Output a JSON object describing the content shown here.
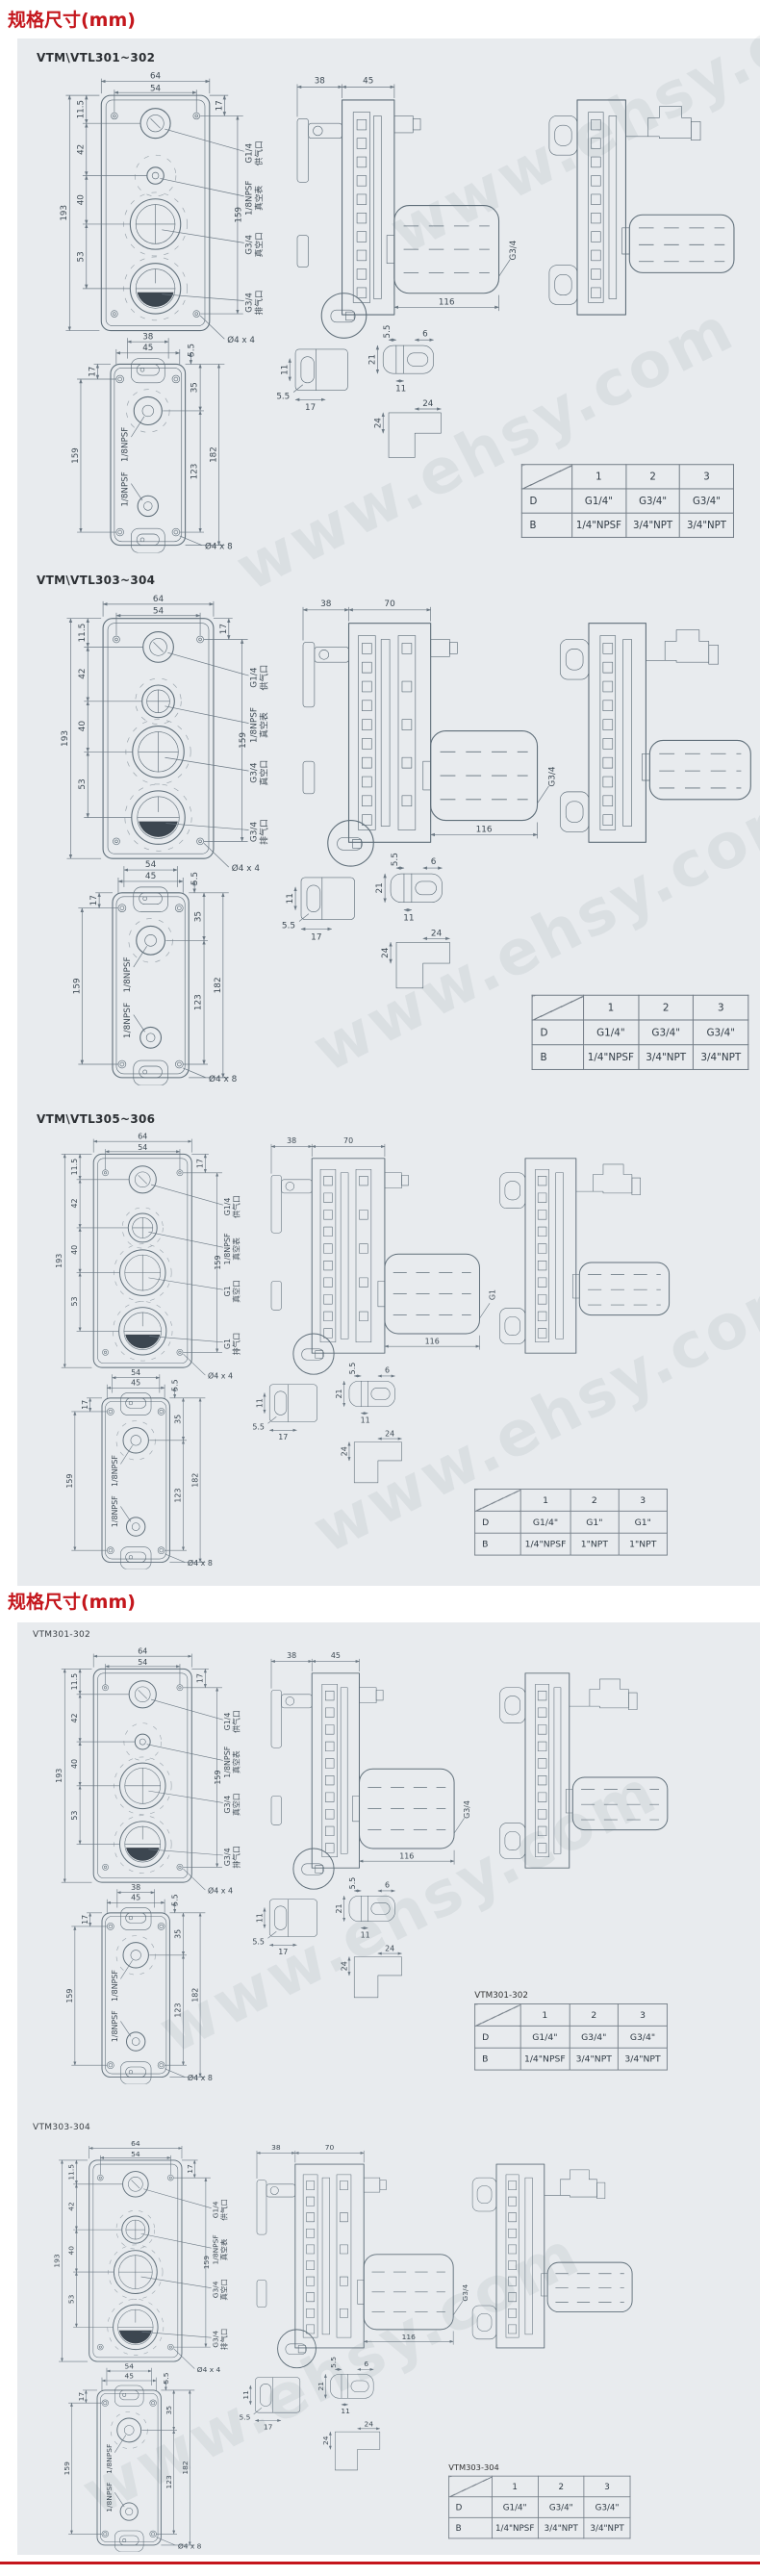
{
  "page": {
    "header1": "规格尺寸(mm)",
    "header2": "规格尺寸(mm)",
    "watermark": "www.ehsy.com",
    "accent_red": "#c4161c",
    "panel_bg": "#e8ebee"
  },
  "sections": [
    {
      "label": "VTM\\VTL301~302",
      "template": "A",
      "front": {
        "dim_w": "64",
        "dim_w2": "54",
        "dim_t": "11.5",
        "dim_s1": "42",
        "dim_s2": "40",
        "dim_s3": "53",
        "dim_h": "193",
        "dim_h2": "159",
        "dim_c": "17",
        "holes": "Ø4 x 4"
      },
      "labels": {
        "supply": "G1/4",
        "supply_cn": "供气口",
        "gauge": "1/8NPSF",
        "gauge_cn": "真空表",
        "vacuum": "G3/4",
        "vacuum_cn": "真空口",
        "exhaust": "G3/4",
        "exhaust_cn": "排气口"
      },
      "side": {
        "dim_a": "38",
        "dim_b": "45",
        "dim_len": "116",
        "muffler": "G3/4"
      },
      "rear": {
        "dim_a": "38",
        "dim_b": "45",
        "dim_corner": "17",
        "dim_off": "5.5",
        "dim_r1": "35",
        "dim_r2": "123",
        "dim_left": "159",
        "dim_total": "182",
        "port1": "1/8NPSF",
        "port2": "1/8NPSF",
        "holes": "Ø4 x 8"
      },
      "parts": {
        "a1": "11",
        "a2": "5.5",
        "a3": "17",
        "b1": "5.5",
        "b2": "6",
        "b3": "21",
        "b4": "11",
        "c1": "24",
        "c2": "24"
      },
      "table": {
        "title": "",
        "cols": [
          "1",
          "2",
          "3"
        ],
        "rows": [
          {
            "h": "D",
            "v": [
              "G1/4\"",
              "G3/4\"",
              "G3/4\""
            ]
          },
          {
            "h": "B",
            "v": [
              "1/4\"NPSF",
              "3/4\"NPT",
              "3/4\"NPT"
            ]
          }
        ]
      }
    },
    {
      "label": "VTM\\VTL303~304",
      "template": "B",
      "front": {
        "dim_w": "64",
        "dim_w2": "54",
        "dim_t": "11.5",
        "dim_s1": "42",
        "dim_s2": "40",
        "dim_s3": "53",
        "dim_h": "193",
        "dim_h2": "159",
        "dim_c": "17",
        "holes": "Ø4 x 4"
      },
      "labels": {
        "supply": "G1/4",
        "supply_cn": "供气口",
        "gauge": "1/8NPSF",
        "gauge_cn": "真空表",
        "vacuum": "G3/4",
        "vacuum_cn": "真空口",
        "exhaust": "G3/4",
        "exhaust_cn": "排气口"
      },
      "side": {
        "dim_a": "38",
        "dim_b": "70",
        "dim_len": "116",
        "muffler": "G3/4"
      },
      "rear": {
        "dim_a": "54",
        "dim_b": "45",
        "dim_corner": "17",
        "dim_off": "5.5",
        "dim_r1": "35",
        "dim_r2": "123",
        "dim_left": "159",
        "dim_total": "182",
        "port1": "1/8NPSF",
        "port2": "1/8NPSF",
        "holes": "Ø4 x 8"
      },
      "parts": {
        "a1": "11",
        "a2": "5.5",
        "a3": "17",
        "b1": "5.5",
        "b2": "6",
        "b3": "21",
        "b4": "11",
        "c1": "24",
        "c2": "24"
      },
      "table": {
        "title": "",
        "cols": [
          "1",
          "2",
          "3"
        ],
        "rows": [
          {
            "h": "D",
            "v": [
              "G1/4\"",
              "G3/4\"",
              "G3/4\""
            ]
          },
          {
            "h": "B",
            "v": [
              "1/4\"NPSF",
              "3/4\"NPT",
              "3/4\"NPT"
            ]
          }
        ]
      }
    },
    {
      "label": "VTM\\VTL305~306",
      "template": "B",
      "front": {
        "dim_w": "64",
        "dim_w2": "54",
        "dim_t": "11.5",
        "dim_s1": "42",
        "dim_s2": "40",
        "dim_s3": "53",
        "dim_h": "193",
        "dim_h2": "159",
        "dim_c": "17",
        "holes": "Ø4 x 4"
      },
      "labels": {
        "supply": "G1/4",
        "supply_cn": "供气口",
        "gauge": "1/8NPSF",
        "gauge_cn": "真空表",
        "vacuum": "G1",
        "vacuum_cn": "真空口",
        "exhaust": "G1",
        "exhaust_cn": "排气口"
      },
      "side": {
        "dim_a": "38",
        "dim_b": "70",
        "dim_len": "116",
        "muffler": "G1"
      },
      "rear": {
        "dim_a": "54",
        "dim_b": "45",
        "dim_corner": "17",
        "dim_off": "5.5",
        "dim_r1": "35",
        "dim_r2": "123",
        "dim_left": "159",
        "dim_total": "182",
        "port1": "1/8NPSF",
        "port2": "1/8NPSF",
        "holes": "Ø4 x 8"
      },
      "parts": {
        "a1": "11",
        "a2": "5.5",
        "a3": "17",
        "b1": "5.5",
        "b2": "6",
        "b3": "21",
        "b4": "11",
        "c1": "24",
        "c2": "24"
      },
      "table": {
        "title": "",
        "cols": [
          "1",
          "2",
          "3"
        ],
        "rows": [
          {
            "h": "D",
            "v": [
              "G1/4\"",
              "G1\"",
              "G1\""
            ]
          },
          {
            "h": "B",
            "v": [
              "1/4\"NPSF",
              "1\"NPT",
              "1\"NPT"
            ]
          }
        ]
      }
    },
    {
      "label": "VTM301-302",
      "template": "A",
      "front": {
        "dim_w": "64",
        "dim_w2": "54",
        "dim_t": "11.5",
        "dim_s1": "42",
        "dim_s2": "40",
        "dim_s3": "53",
        "dim_h": "193",
        "dim_h2": "159",
        "dim_c": "17",
        "holes": "Ø4 x 4"
      },
      "labels": {
        "supply": "G1/4",
        "supply_cn": "供气口",
        "gauge": "1/8NPSF",
        "gauge_cn": "真空表",
        "vacuum": "G3/4",
        "vacuum_cn": "真空口",
        "exhaust": "G3/4",
        "exhaust_cn": "排气口"
      },
      "side": {
        "dim_a": "38",
        "dim_b": "45",
        "dim_len": "116",
        "muffler": "G3/4"
      },
      "rear": {
        "dim_a": "38",
        "dim_b": "45",
        "dim_corner": "17",
        "dim_off": "5.5",
        "dim_r1": "35",
        "dim_r2": "123",
        "dim_left": "159",
        "dim_total": "182",
        "port1": "1/8NPSF",
        "port2": "1/8NPSF",
        "holes": "Ø4 x 8"
      },
      "parts": {
        "a1": "11",
        "a2": "5.5",
        "a3": "17",
        "b1": "5.5",
        "b2": "6",
        "b3": "21",
        "b4": "11",
        "c1": "24",
        "c2": "24"
      },
      "table": {
        "title": "VTM301-302",
        "cols": [
          "1",
          "2",
          "3"
        ],
        "rows": [
          {
            "h": "D",
            "v": [
              "G1/4\"",
              "G3/4\"",
              "G3/4\""
            ]
          },
          {
            "h": "B",
            "v": [
              "1/4\"NPSF",
              "3/4\"NPT",
              "3/4\"NPT"
            ]
          }
        ]
      }
    },
    {
      "label": "VTM303-304",
      "template": "B",
      "front": {
        "dim_w": "64",
        "dim_w2": "54",
        "dim_t": "11.5",
        "dim_s1": "42",
        "dim_s2": "40",
        "dim_s3": "53",
        "dim_h": "193",
        "dim_h2": "159",
        "dim_c": "17",
        "holes": "Ø4 x 4"
      },
      "labels": {
        "supply": "G1/4",
        "supply_cn": "供气口",
        "gauge": "1/8NPSF",
        "gauge_cn": "真空表",
        "vacuum": "G3/4",
        "vacuum_cn": "真空口",
        "exhaust": "G3/4",
        "exhaust_cn": "排气口"
      },
      "side": {
        "dim_a": "38",
        "dim_b": "70",
        "dim_len": "116",
        "muffler": "G3/4"
      },
      "rear": {
        "dim_a": "54",
        "dim_b": "45",
        "dim_corner": "17",
        "dim_off": "5.5",
        "dim_r1": "35",
        "dim_r2": "123",
        "dim_left": "159",
        "dim_total": "182",
        "port1": "1/8NPSF",
        "port2": "1/8NPSF",
        "holes": "Ø4 x 8"
      },
      "parts": {
        "a1": "11",
        "a2": "5.5",
        "a3": "17",
        "b1": "5.5",
        "b2": "6",
        "b3": "21",
        "b4": "11",
        "c1": "24",
        "c2": "24"
      },
      "table": {
        "title": "VTM303-304",
        "cols": [
          "1",
          "2",
          "3"
        ],
        "rows": [
          {
            "h": "D",
            "v": [
              "G1/4\"",
              "G3/4\"",
              "G3/4\""
            ]
          },
          {
            "h": "B",
            "v": [
              "1/4\"NPSF",
              "3/4\"NPT",
              "3/4\"NPT"
            ]
          }
        ]
      }
    }
  ]
}
